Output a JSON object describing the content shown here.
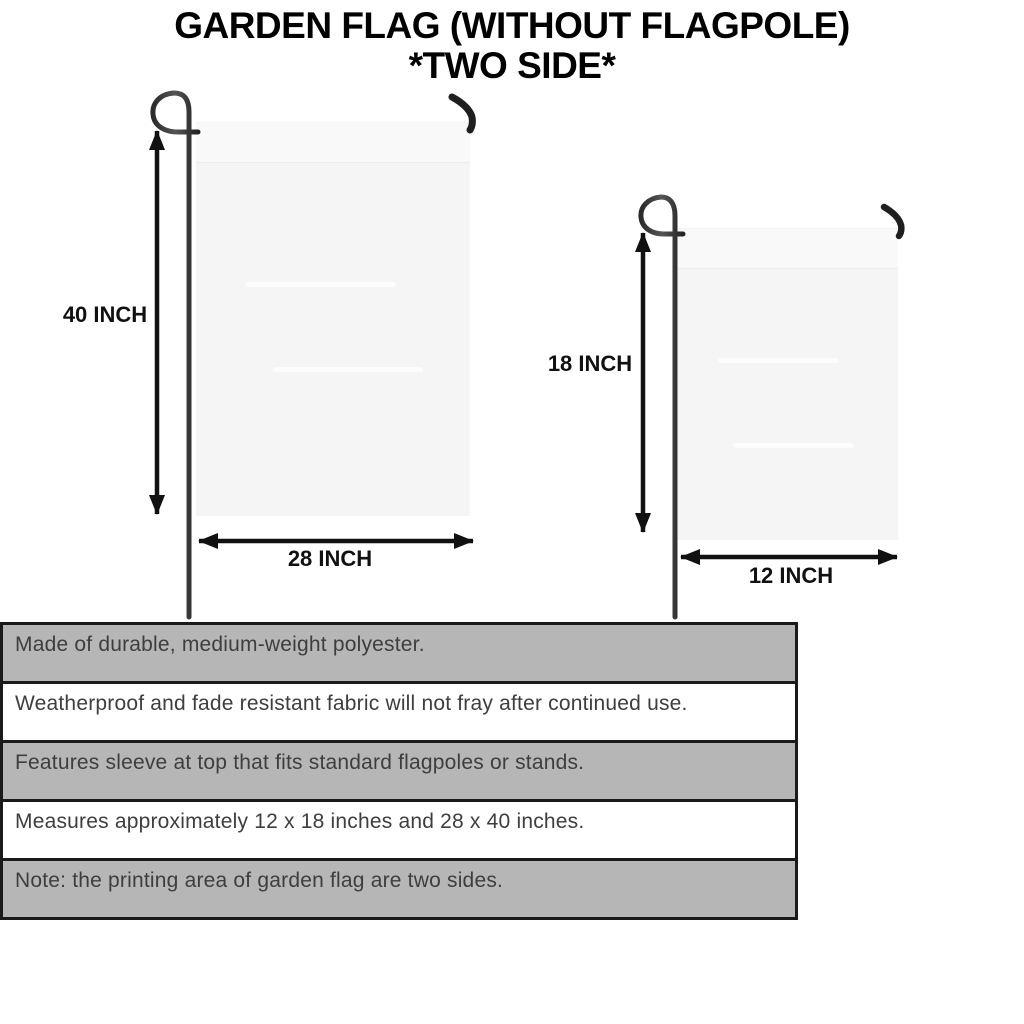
{
  "title": {
    "line1": "GARDEN FLAG (WITHOUT FLAGPOLE)",
    "line2": "*TWO SIDE*"
  },
  "flags": {
    "large": {
      "height_label": "40 INCH",
      "width_label": "28 INCH"
    },
    "small": {
      "height_label": "18 INCH",
      "width_label": "12 INCH"
    }
  },
  "features": [
    {
      "text": "Made of durable, medium-weight polyester.",
      "shaded": true
    },
    {
      "text": "Weatherproof and fade resistant fabric will not fray after continued use.",
      "shaded": false
    },
    {
      "text": "Features sleeve at top that fits standard flagpoles or stands.",
      "shaded": true
    },
    {
      "text": "Measures approximately 12 x 18 inches and 28 x 40 inches.",
      "shaded": false
    },
    {
      "text": "Note: the printing area of garden flag are two sides.",
      "shaded": true
    }
  ],
  "colors": {
    "shaded_row": "#b6b6b6",
    "plain_row": "#ffffff",
    "box_border": "#1a1a1a",
    "flag_fabric": "#f5f5f5",
    "metal_pole": "#3a3a3a",
    "hook_metal": "#1f1f1f",
    "arrow_black": "#111111",
    "feature_text": "#3e3e3e",
    "title_text": "#000000"
  }
}
